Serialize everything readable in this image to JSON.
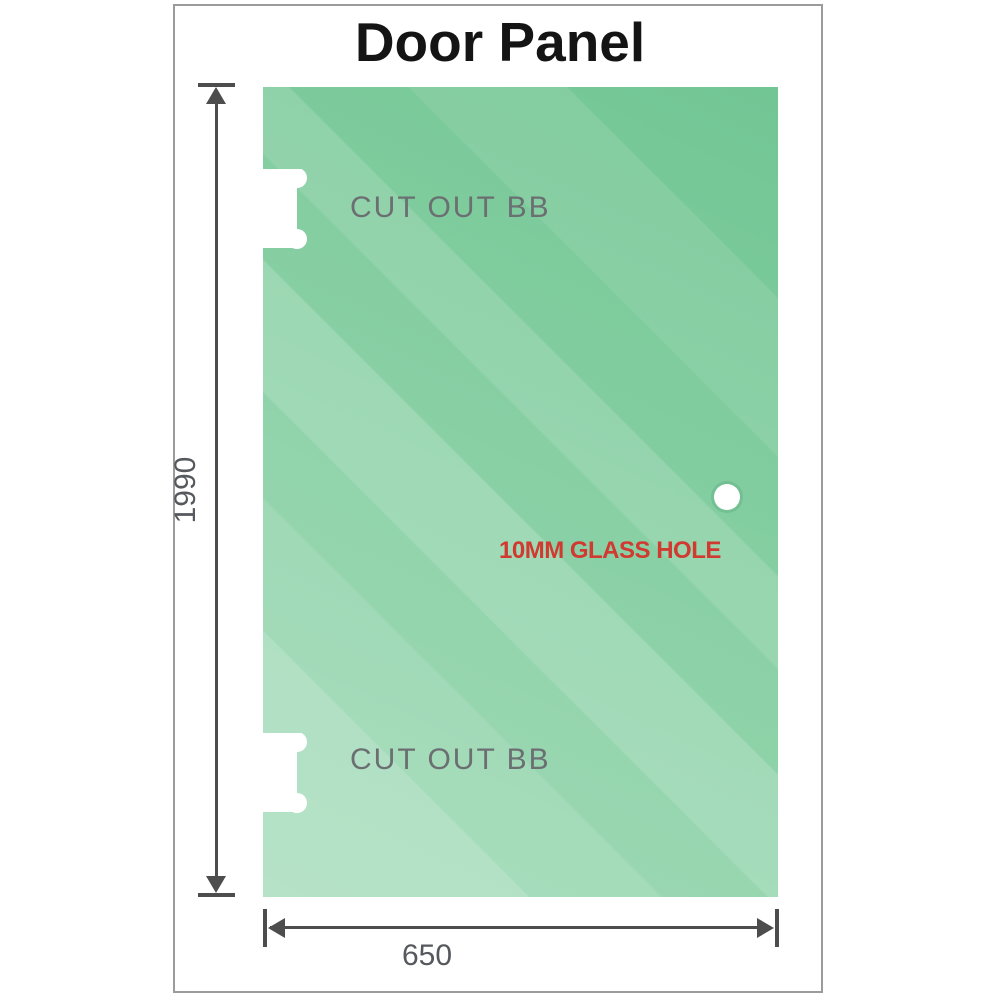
{
  "title": "Door Panel",
  "glass_panel": {
    "cutouts": [
      {
        "label": "CUT OUT BB",
        "position": "top-left"
      },
      {
        "label": "CUT OUT BB",
        "position": "bottom-left"
      }
    ],
    "hole": {
      "label": "10MM GLASS HOLE",
      "diameter_mm": "10"
    }
  },
  "dimensions": {
    "height": {
      "value": "1990"
    },
    "width": {
      "value": "650"
    }
  },
  "colors": {
    "glass_green_dark": "#72c694",
    "glass_green_light": "#a8debf",
    "dimension_line": "#4d4d4d",
    "dimension_text": "#55585c",
    "cutout_text": "#6b6f72",
    "hole_text": "#d03a30",
    "frame_border": "#9b9b9b",
    "title_text": "#141414"
  }
}
